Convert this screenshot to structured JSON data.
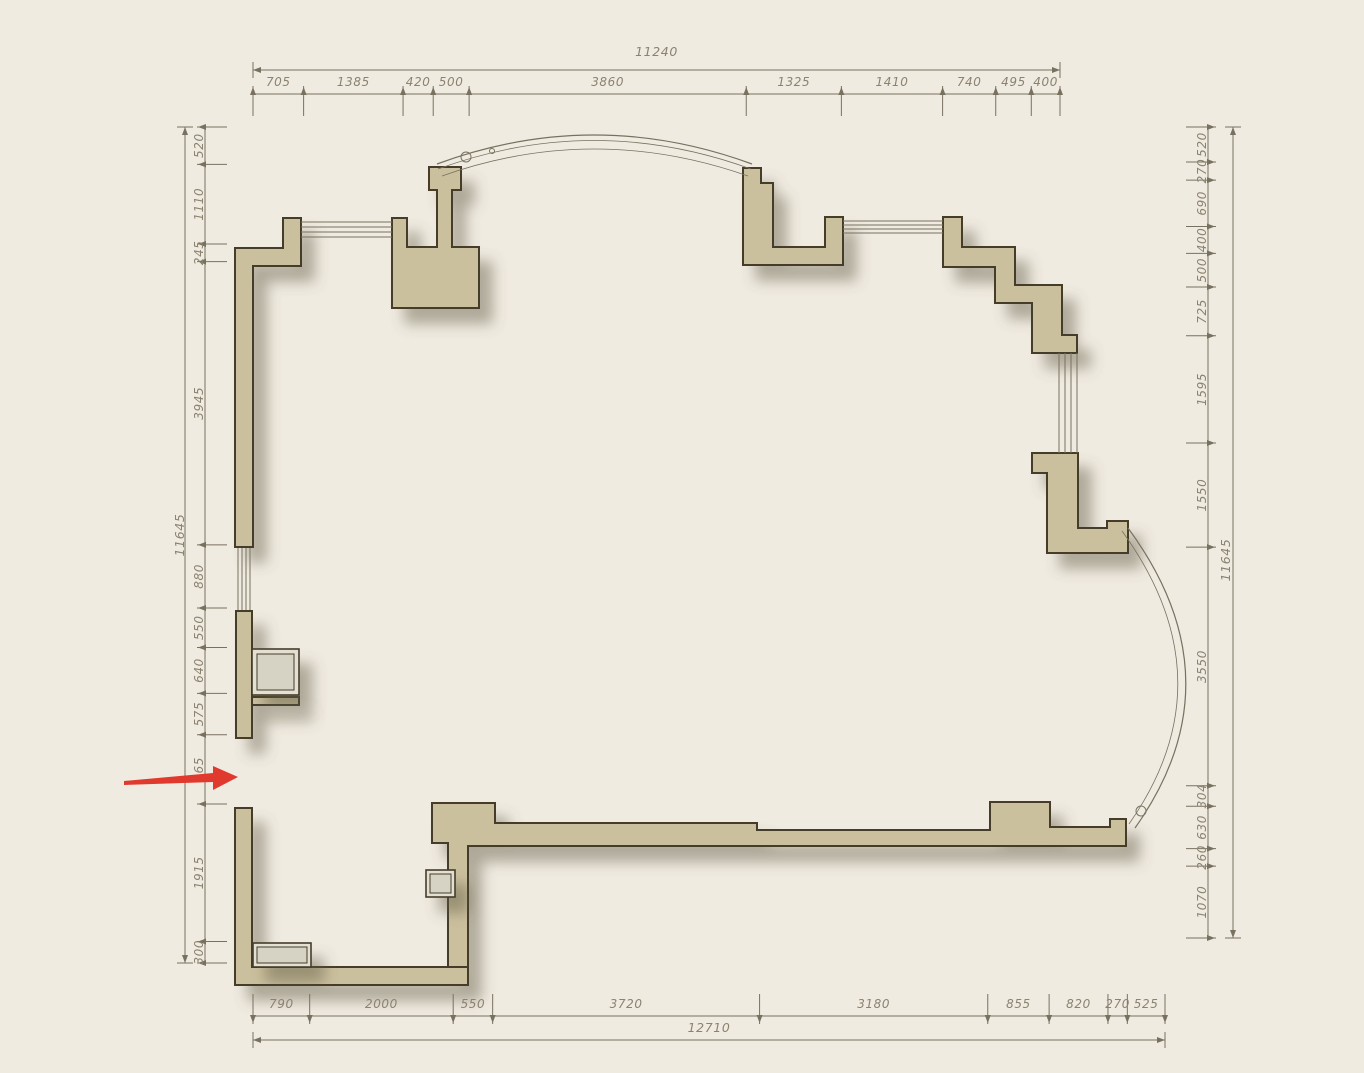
{
  "colors": {
    "background": "#f0ebe1",
    "wall_fill": "#cbc09e",
    "wall_outline": "#453d2c",
    "line": "#78715f",
    "dim_text": "#8b8270",
    "arrow_red": "#e0392e",
    "fixture_fill": "#e3dfd2"
  },
  "dimensions": {
    "top": {
      "overall": "11240",
      "segments": [
        "705",
        "1385",
        "420",
        "500",
        "3860",
        "1325",
        "1410",
        "740",
        "495",
        "400"
      ]
    },
    "bottom": {
      "overall": "12710",
      "segments": [
        "790",
        "2000",
        "550",
        "3720",
        "3180",
        "855",
        "820",
        "270",
        "525"
      ]
    },
    "left": {
      "overall": "11645",
      "segments": [
        "520",
        "1110",
        "245",
        "3945",
        "880",
        "550",
        "640",
        "575",
        "965",
        "1915",
        "300"
      ]
    },
    "right": {
      "overall": "11645",
      "segments": [
        "520",
        "270",
        "690",
        "400",
        "500",
        "725",
        "1595",
        "1550",
        "3550",
        "304",
        "630",
        "260",
        "1070"
      ]
    }
  },
  "annotation": {
    "arrow_color": "#e0392e"
  }
}
